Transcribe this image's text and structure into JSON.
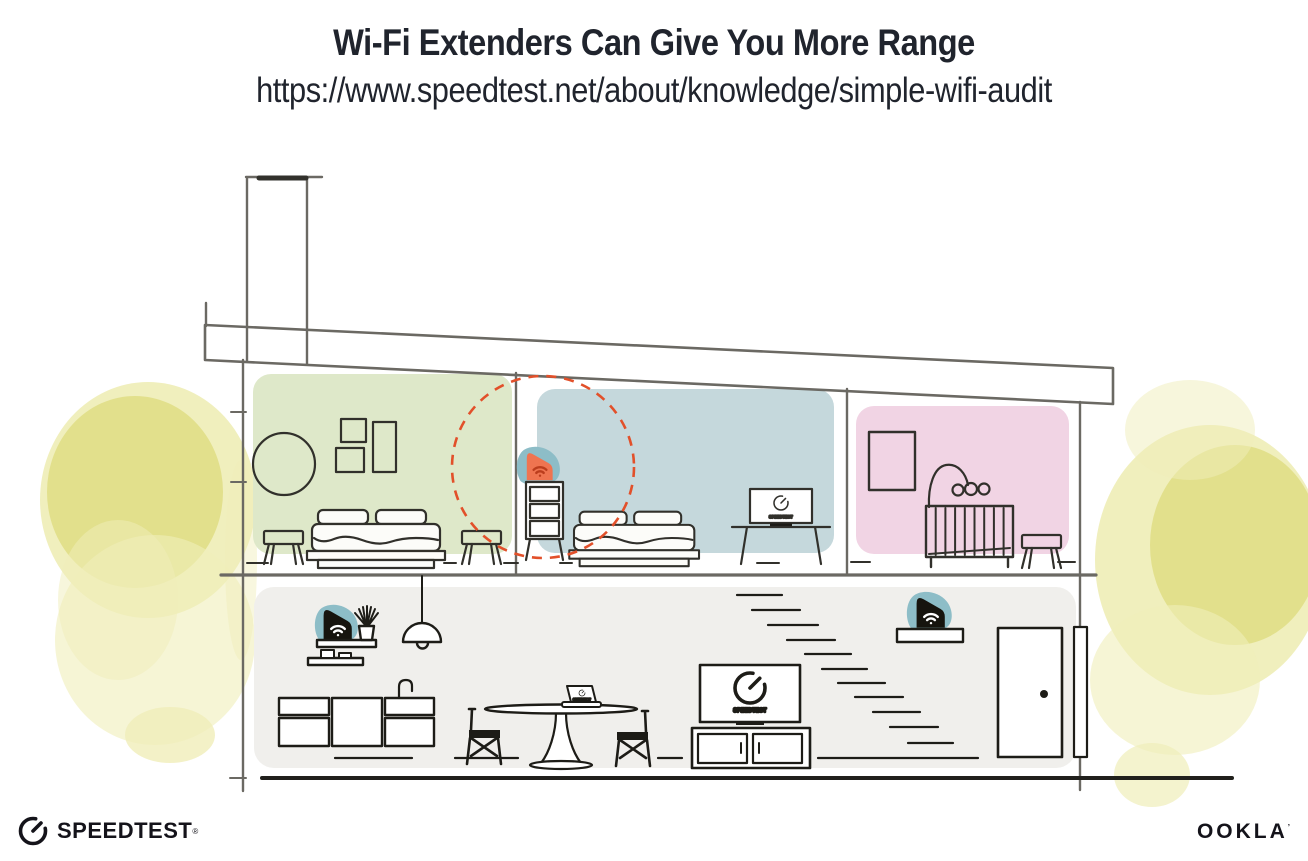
{
  "header": {
    "title": "Wi-Fi Extenders Can Give You More Range",
    "url": "https://www.speedtest.net/about/knowledge/simple-wifi-audit"
  },
  "footer": {
    "speedtest_wordmark": "SPEEDTEST",
    "speedtest_trademark": "®",
    "ookla_wordmark": "OOKLA",
    "ookla_trademark": "’"
  },
  "illustration": {
    "tv_screen_label": "SPEEDTEST",
    "icons": {
      "wifi_icon": "wifi signal arcs",
      "gauge_icon": "speedtest gauge dial"
    },
    "colors": {
      "heading_text": "#20242d",
      "logo_ink": "#14131a",
      "wall_line": "#6b6963",
      "furniture_line_upper": "#31302b",
      "furniture_line_lower": "#1d1c17",
      "room_green": "#dee8c9",
      "room_blue": "#c5d8dc",
      "room_pink": "#f1d4e4",
      "floor_gray": "#f0efec",
      "device_teal": "#8dbdc7",
      "device_orange": "#ef7450",
      "wifi_on_orange": "#bb3d1d",
      "device_black": "#16140e",
      "range_circle": "#e2502a",
      "foliage_core": "#d9d66b",
      "foliage_mid": "#e3e187",
      "foliage_pale": "#f0eeb9"
    }
  }
}
